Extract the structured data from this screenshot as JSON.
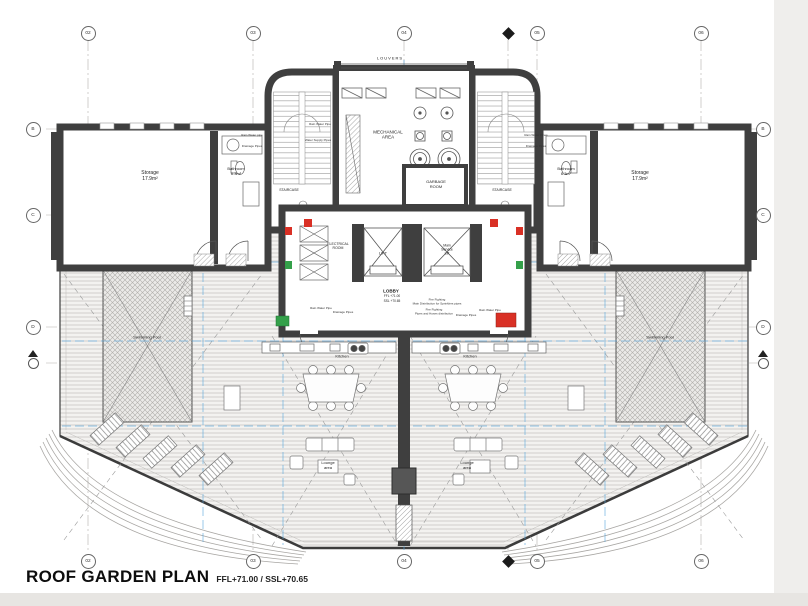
{
  "title": {
    "main": "ROOF GARDEN PLAN",
    "levels": "FFL+71.00 / SSL+70.65"
  },
  "grid": {
    "columns": [
      "02",
      "03",
      "04",
      "05",
      "06"
    ],
    "rows": [
      "B",
      "C",
      "D"
    ]
  },
  "rooms": {
    "louvers": "LOUVERS",
    "mechanical": "MECHANICAL\nAREA",
    "garbage": "GARBAGE\nROOM",
    "staircase": "STAIRCASE",
    "storage": "Storage\n17.9m²",
    "bathroom": "Bathroom\n6.3m²",
    "electrical": "ELECTRICAL\nROOM",
    "lift": "LIFT",
    "service_lift": "Main\nService\nLift",
    "lobby": "LOBBY",
    "lobby_ffl": "FFL +71.00",
    "lobby_ssl": "SSL +70.65",
    "pool": "Swimming Pool",
    "kitchen": "Kitchen",
    "lounge": "Lounge\narea"
  },
  "annotations": {
    "rain_water": "Rain Water Pipe",
    "rain_water_alt": "Rain Water pipe",
    "rain_water_pl": "Rain Water Pipes",
    "drainage": "Drainage Pipes",
    "water_supply": "Water Supply Pipes",
    "fire_main": "Fire Fighting\nMain Distribution for Sprinklers pipes",
    "fire_dist": "Fire Fighting\nPipes and Hoses distribution"
  },
  "colors": {
    "wall": "#3f3f3f",
    "cad_blue": "#58a6dd",
    "fire_red": "#d93025",
    "fire_green": "#34a04a",
    "deck_line": "#c9c7c4"
  }
}
